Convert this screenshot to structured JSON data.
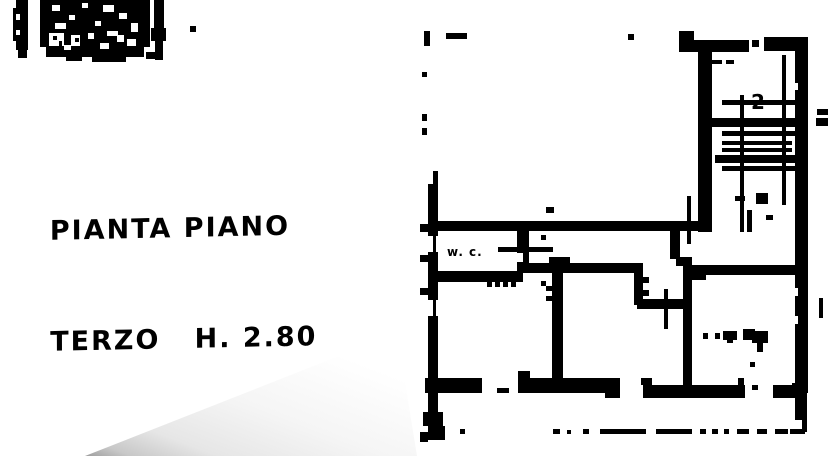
{
  "caption": {
    "line1": "PIANTA PIANO",
    "line2": "TERZO   H. 2.80"
  },
  "floorplan": {
    "wc_label": "w. c.",
    "stair_mark": "2"
  },
  "colors": {
    "ink": "#000000",
    "paper": "#ffffff",
    "fold_shadow": "#9e9e9e"
  }
}
